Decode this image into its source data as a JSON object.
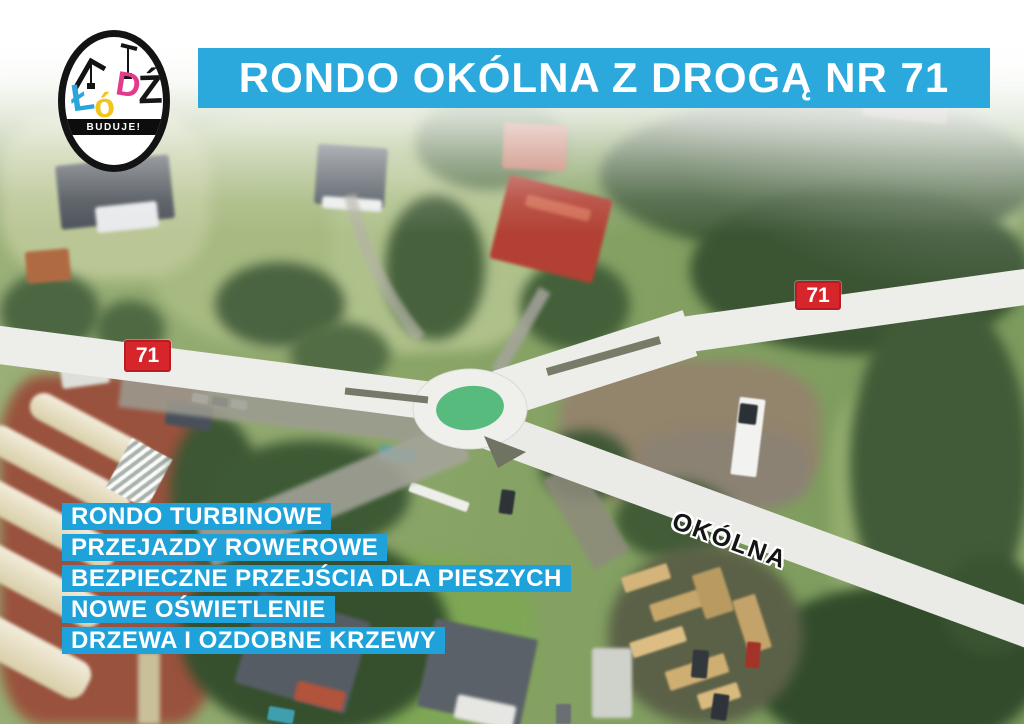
{
  "header": {
    "title": "RONDO OKÓLNA Z DROGĄ NR 71"
  },
  "logo": {
    "letters": [
      "Ł",
      "ó",
      "D",
      "Ź"
    ],
    "tagline": "BUDUJE!"
  },
  "map": {
    "badge_left": "71",
    "badge_right": "71",
    "street_label": "OKÓLNA"
  },
  "features": {
    "items": [
      "RONDO TURBINOWE",
      "PRZEJAZDY ROWEROWE",
      "BEZPIECZNE PRZEJŚCIA DLA PIESZYCH",
      "NOWE OŚWIETLENIE",
      "DRZEWA I OZDOBNE KRZEWY"
    ]
  },
  "colors": {
    "banner_blue": "#2BA8DC",
    "feature_blue": "#1FA2DA",
    "badge_red": "#D7252C",
    "island_green": "#58BB7E",
    "road_overlay": "#EDEDEA",
    "logo_cyan": "#29A5DC",
    "logo_yellow": "#F2C51D",
    "logo_magenta": "#E53A8B"
  }
}
